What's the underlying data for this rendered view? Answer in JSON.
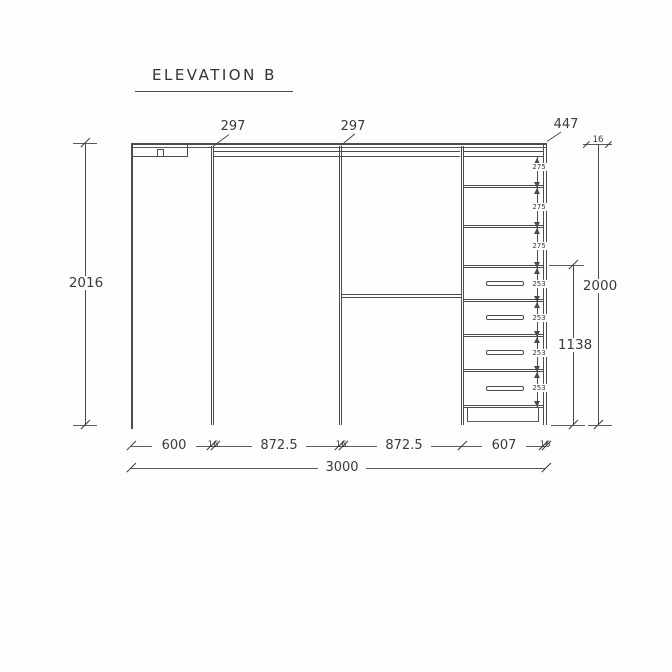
{
  "title": "ELEVATION B",
  "dims": {
    "top_shelf_left": "297",
    "top_shelf_right": "297",
    "top_corner": "447",
    "top_panel": "16",
    "total_height": "2016",
    "carcass_height": "2000",
    "drawer_stack_height": "1138",
    "shelf_gaps": [
      "275",
      "275",
      "275"
    ],
    "drawer_gaps": [
      "253",
      "253",
      "253",
      "253"
    ],
    "bottom_segments": [
      "600",
      "16",
      "872.5",
      "16",
      "872.5",
      "607",
      "16"
    ],
    "total_width": "3000"
  }
}
